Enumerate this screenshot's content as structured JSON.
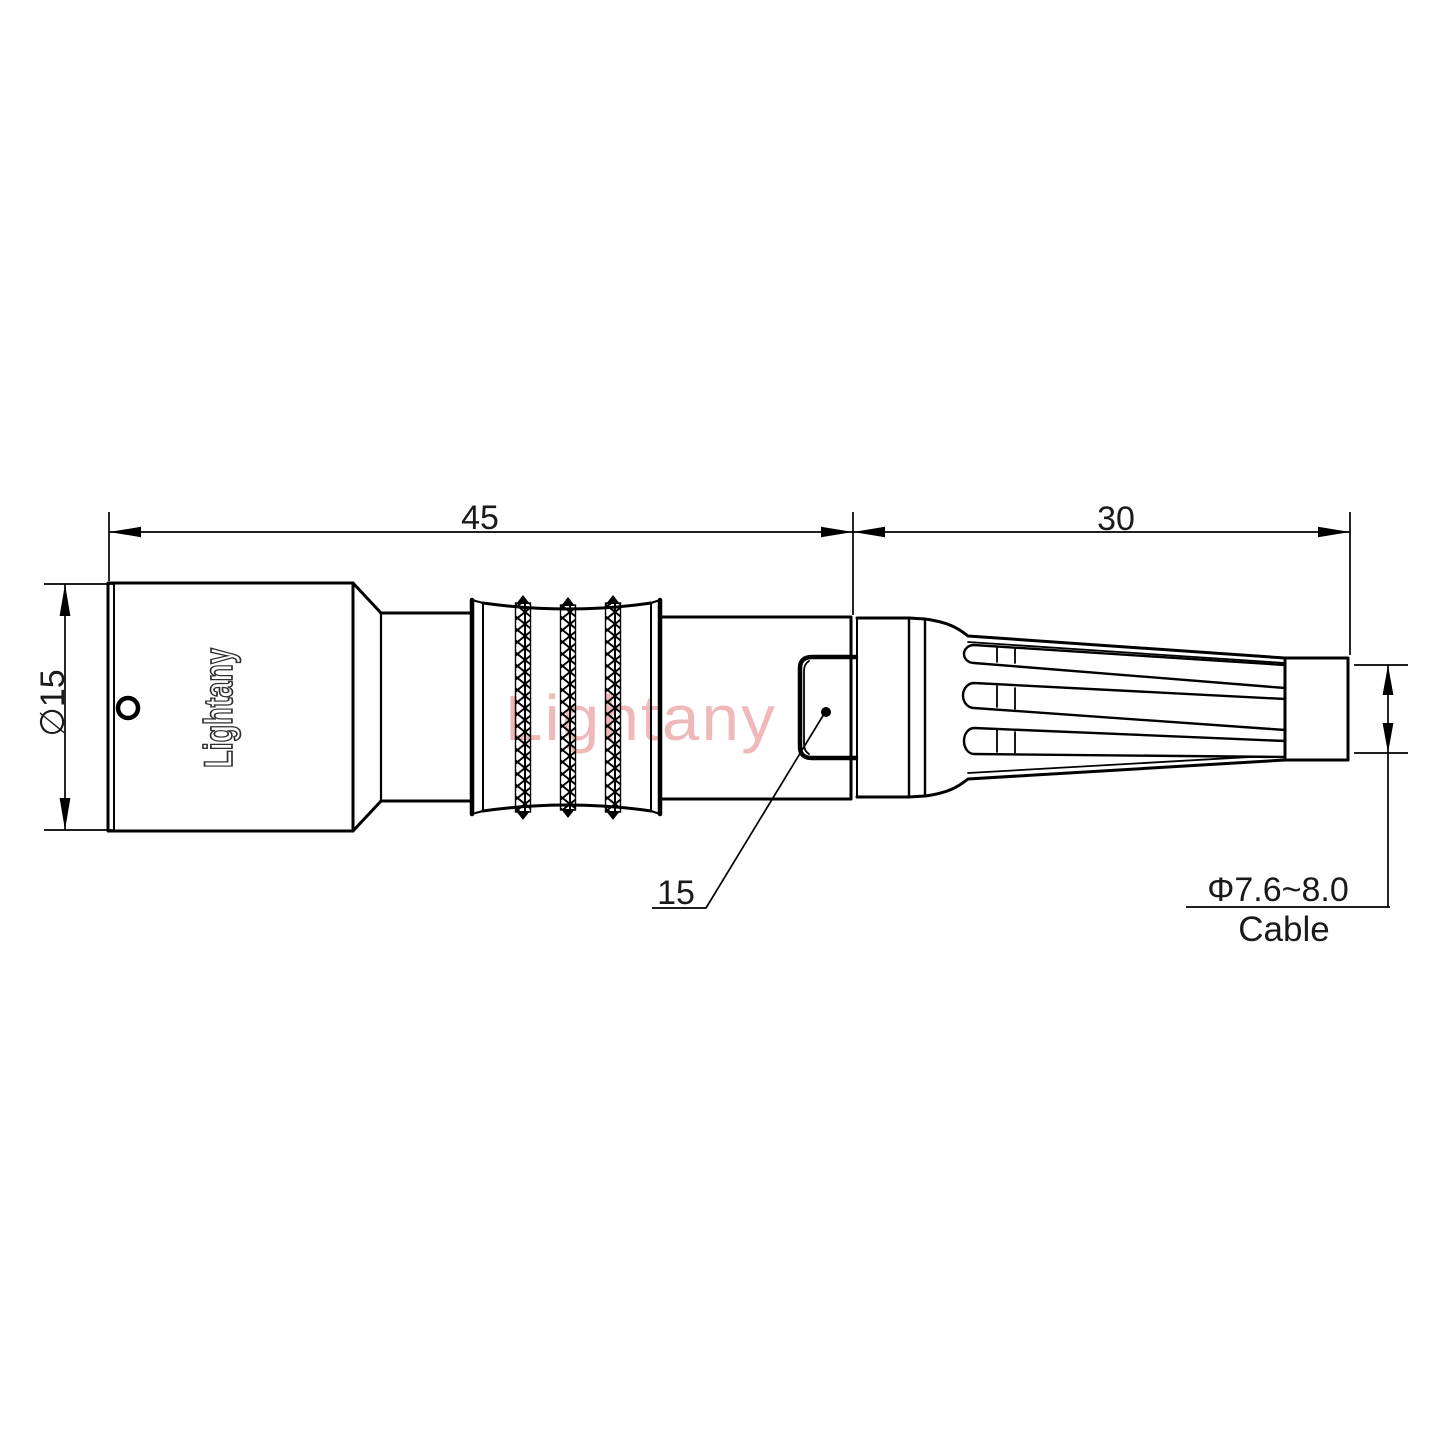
{
  "page": {
    "background": "#ffffff"
  },
  "drawing": {
    "logo_text": "Lightany",
    "watermark_text": "Lightany",
    "dimensions": {
      "body_length": "45",
      "gland_length": "30",
      "body_diameter": "∅15",
      "latch_size": "15",
      "cable_diameter": "Φ7.6~8.0",
      "cable_label": "Cable"
    },
    "colors": {
      "line": "#000000",
      "text": "#1a1a1a",
      "logo_stroke": "#2f2f2f",
      "watermark": "#f0b9b9"
    }
  }
}
